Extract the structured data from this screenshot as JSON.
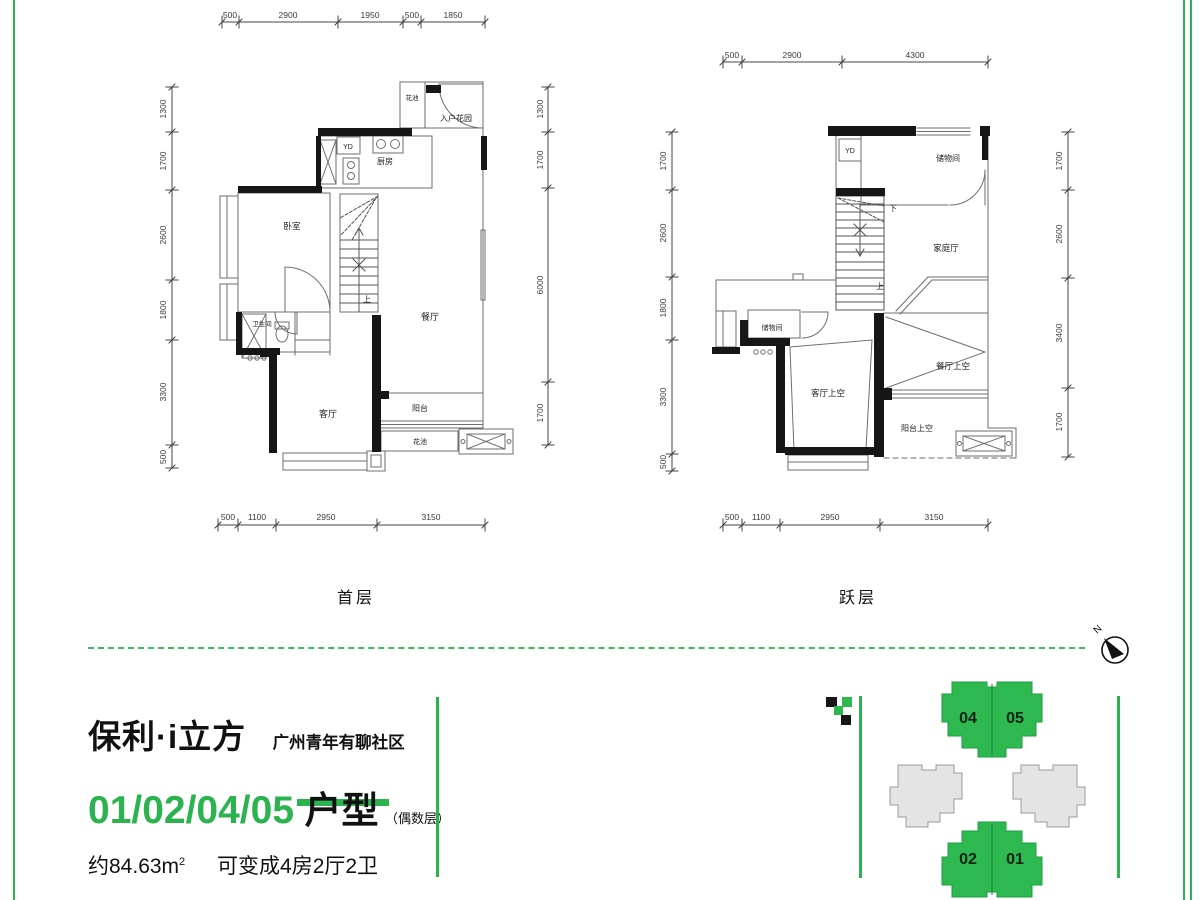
{
  "colors": {
    "green": "#2cb350",
    "building_green": "#2db850",
    "building_gray": "#e4e4e4",
    "wall": "#161616"
  },
  "plans": {
    "first": {
      "label": "首层",
      "dims_top": [
        "500",
        "2900",
        "1950",
        "500",
        "1850"
      ],
      "dims_bottom": [
        "500",
        "1100",
        "2950",
        "3150"
      ],
      "dims_left": [
        "1300",
        "1700",
        "2600",
        "1800",
        "3300",
        "500"
      ],
      "dims_right": [
        "1300",
        "1700",
        "6000",
        "1700"
      ],
      "rooms": {
        "flower_top": "花池",
        "entry_garden": "入户花园",
        "yd": "YD",
        "kitchen": "厨房",
        "bedroom": "卧室",
        "bath": "卫生间",
        "stair": "上",
        "dining": "餐厅",
        "living": "客厅",
        "balcony": "阳台",
        "flower_bottom": "花池"
      }
    },
    "loft": {
      "label": "跃层",
      "dims_top": [
        "500",
        "2900",
        "4300"
      ],
      "dims_bottom": [
        "500",
        "1100",
        "2950",
        "3150"
      ],
      "dims_left": [
        "1700",
        "2600",
        "1800",
        "3300",
        "500"
      ],
      "dims_right": [
        "1700",
        "2600",
        "3400",
        "1700"
      ],
      "rooms": {
        "yd": "YD",
        "storage_top": "储物间",
        "stair_down": "下",
        "family": "家庭厅",
        "stair_up": "上",
        "storage_mid": "储物间",
        "living_void": "客厅上空",
        "dining_void": "餐厅上空",
        "balcony_void": "阳台上空"
      }
    }
  },
  "branding": {
    "brand": "保利·i立方",
    "community": "广州青年有聊社区",
    "unit_numbers": "01/02/04/05",
    "unit_type": "户型",
    "floor_note": "（偶数层）",
    "area": "约84.63m",
    "area_sup": "2",
    "description": "可变成4房2厅2卫"
  },
  "site_plan": {
    "north": "N",
    "buildings": {
      "b04": "04",
      "b05": "05",
      "b02": "02",
      "b01": "01"
    }
  }
}
